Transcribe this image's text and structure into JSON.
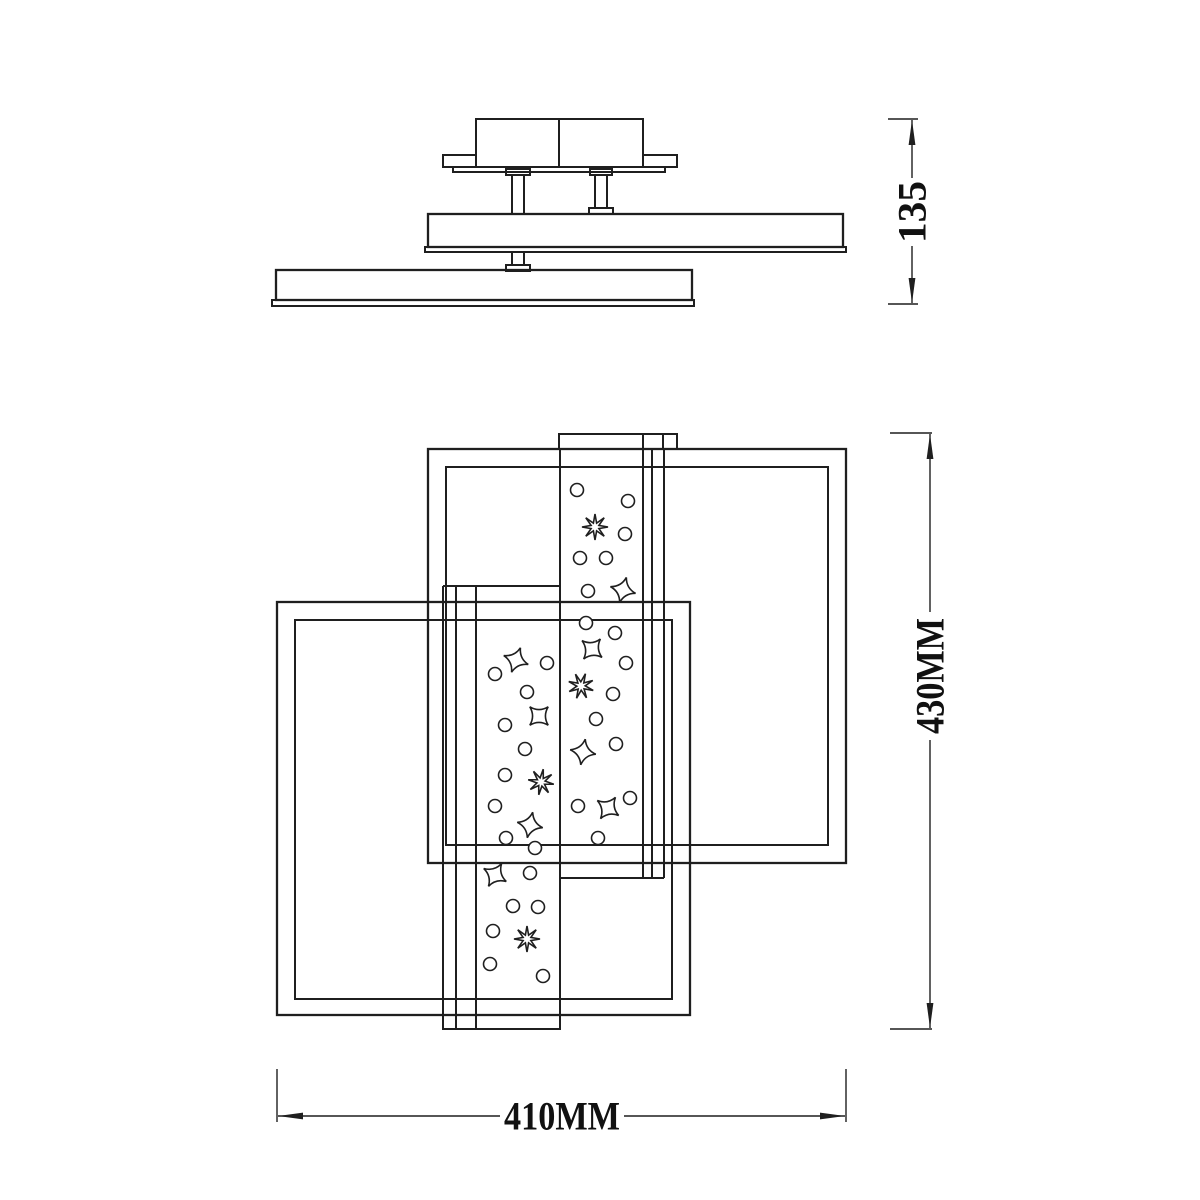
{
  "colors": {
    "background": "#ffffff",
    "line": "#1f1f1f",
    "text": "#111111"
  },
  "dimensions": {
    "fixture_height": {
      "label": "135"
    },
    "overall_length": {
      "label": "430MM"
    },
    "overall_width": {
      "label": "410MM"
    }
  },
  "decorations": {
    "right_strip": {
      "circles": [
        [
          577,
          490
        ],
        [
          628,
          501
        ],
        [
          625,
          534
        ],
        [
          580,
          558
        ],
        [
          606,
          558
        ],
        [
          588,
          591
        ],
        [
          586,
          623
        ],
        [
          615,
          633
        ],
        [
          626,
          663
        ],
        [
          613,
          694
        ],
        [
          596,
          719
        ],
        [
          616,
          744
        ],
        [
          630,
          798
        ],
        [
          578,
          806
        ],
        [
          598,
          838
        ]
      ],
      "stars4": [
        [
          623,
          590,
          15
        ],
        [
          592,
          649,
          40
        ],
        [
          583,
          752,
          10
        ],
        [
          608,
          808,
          35
        ]
      ],
      "stars8": [
        [
          595,
          527,
          0
        ],
        [
          581,
          686,
          20
        ]
      ]
    },
    "left_strip": {
      "circles": [
        [
          547,
          663
        ],
        [
          495,
          674
        ],
        [
          527,
          692
        ],
        [
          505,
          725
        ],
        [
          525,
          749
        ],
        [
          505,
          775
        ],
        [
          495,
          806
        ],
        [
          506,
          838
        ],
        [
          535,
          848
        ],
        [
          530,
          873
        ],
        [
          513,
          906
        ],
        [
          538,
          907
        ],
        [
          493,
          931
        ],
        [
          490,
          964
        ],
        [
          543,
          976
        ]
      ],
      "stars4": [
        [
          516,
          660,
          20
        ],
        [
          539,
          716,
          45
        ],
        [
          530,
          825,
          12
        ],
        [
          495,
          875,
          30
        ]
      ],
      "stars8": [
        [
          541,
          782,
          10
        ],
        [
          527,
          939,
          0
        ]
      ]
    }
  }
}
